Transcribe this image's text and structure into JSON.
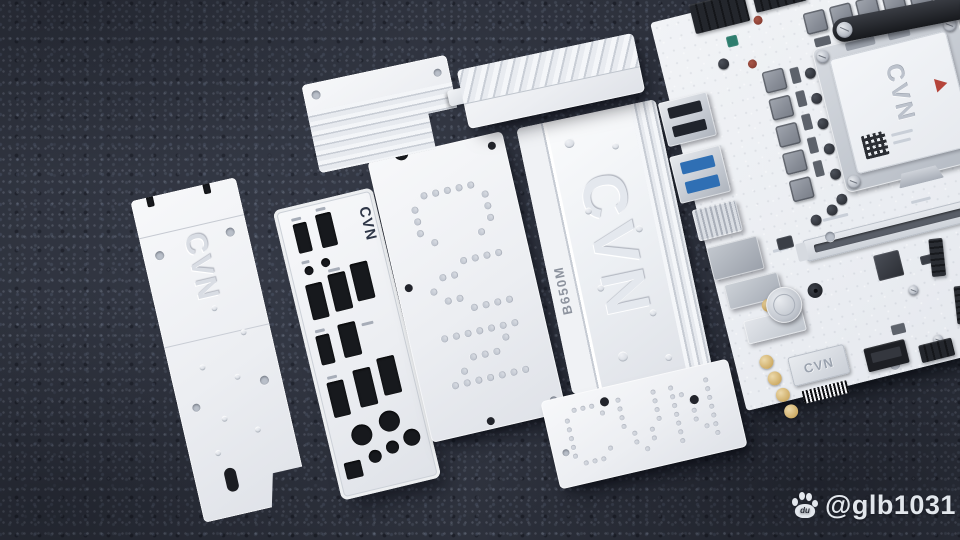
{
  "scene": {
    "description": "White CVN B650M motherboard, heatsinks, backplates and I/O shield laid out on dark gray carpet",
    "carpet_color": "#2d313c",
    "part_color": "#eef0f4",
    "accent_blue": "#1e7ec2",
    "warning_red": "#b5443a"
  },
  "watermark": {
    "logo_text": "du",
    "handle": "@glb1031"
  },
  "parts": {
    "rear_backplate": {
      "brand": "CVN"
    },
    "io_shield": {
      "brand": "CVN"
    },
    "dotted_backplate": {
      "dot_text": "CVN"
    },
    "chipset_heatsink": {
      "model": "B650M",
      "brand_embossed": "CVN"
    },
    "small_backplate": {
      "dot_text": "CVN"
    },
    "motherboard": {
      "cpu_socket_cover_brand": "CVN",
      "audio_module_brand": "CVN"
    }
  }
}
